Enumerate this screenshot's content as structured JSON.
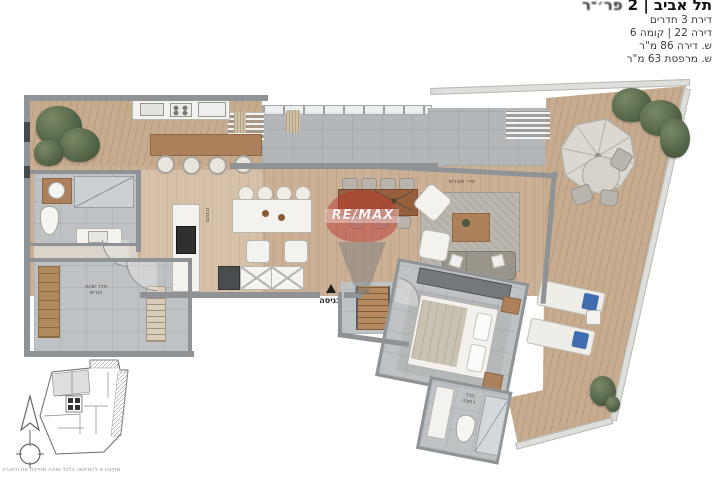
{
  "header": {
    "street": "פר׳־ר",
    "number_sep": "2 |",
    "city": "תל אביב",
    "lines": [
      "דירת 3 חדרים",
      "דירה 22 | קומה 6",
      "ש. דירה 86 מ\"ר",
      "ש. מרפסת 63 מ\"ר"
    ]
  },
  "plan": {
    "watermark": "RE/MAX",
    "labels": {
      "entrance": "כניסה",
      "living_room": "חדר מגורים",
      "kitchen": "מטבח",
      "bedroom_line1": "חדר שינה",
      "bedroom_line2": "הורים",
      "bathroom_line1": "חדר",
      "bathroom_line2": "רחצה"
    },
    "colors": {
      "wood_floor": "#c9ae94",
      "terrace_deck": "#c4a98e",
      "tile_gray": "#bcbfc1",
      "wall_gray": "#8f9396",
      "remax_red": "#ba342b",
      "towel_blue": "#3f6db0",
      "plant_green": "#5d6e4d"
    }
  },
  "footer": {
    "disclaimer": "סקיצה זו להמחשה בלבד ואינה מחייבת את החברה"
  }
}
